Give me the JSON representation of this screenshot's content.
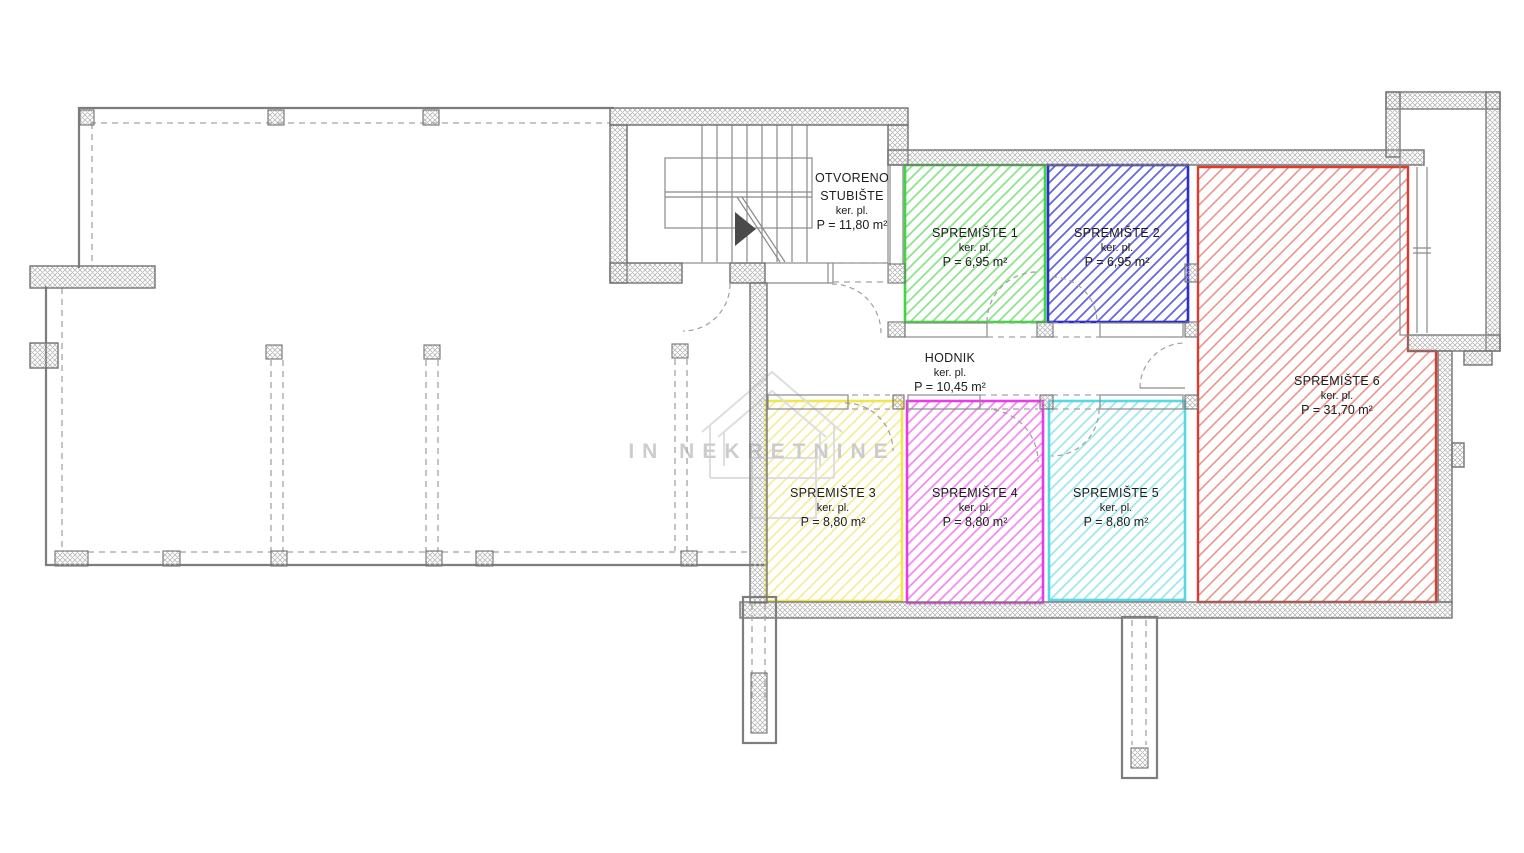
{
  "plan": {
    "watermark": "IN NEKRETNINE",
    "rooms": [
      {
        "id": "otvoreno-stubiste",
        "name_line1": "OTVORENO",
        "name_line2": "STUBIŠTE",
        "floor": "ker. pl.",
        "area": "P = 11,80 m²",
        "color": "#1c1c1c"
      },
      {
        "id": "spremiste-1",
        "name": "SPREMIŠTE 1",
        "floor": "ker. pl.",
        "area": "P = 6,95 m²",
        "color": "#3fd63f"
      },
      {
        "id": "spremiste-2",
        "name": "SPREMIŠTE 2",
        "floor": "ker. pl.",
        "area": "P = 6,95 m²",
        "color": "#2b2fd0"
      },
      {
        "id": "hodnik",
        "name": "HODNIK",
        "floor": "ker. pl.",
        "area": "P = 10,45 m²",
        "color": "#1c1c1c"
      },
      {
        "id": "spremiste-3",
        "name": "SPREMIŠTE 3",
        "floor": "ker. pl.",
        "area": "P = 8,80 m²",
        "color": "#f0e74e"
      },
      {
        "id": "spremiste-4",
        "name": "SPREMIŠTE 4",
        "floor": "ker. pl.",
        "area": "P = 8,80 m²",
        "color": "#e93ce9"
      },
      {
        "id": "spremiste-5",
        "name": "SPREMIŠTE 5",
        "floor": "ker. pl.",
        "area": "P = 8,80 m²",
        "color": "#57d9e4"
      },
      {
        "id": "spremiste-6",
        "name": "SPREMIŠTE 6",
        "floor": "ker. pl.",
        "area": "P = 31,70 m²",
        "color": "#dc3c30"
      }
    ]
  }
}
